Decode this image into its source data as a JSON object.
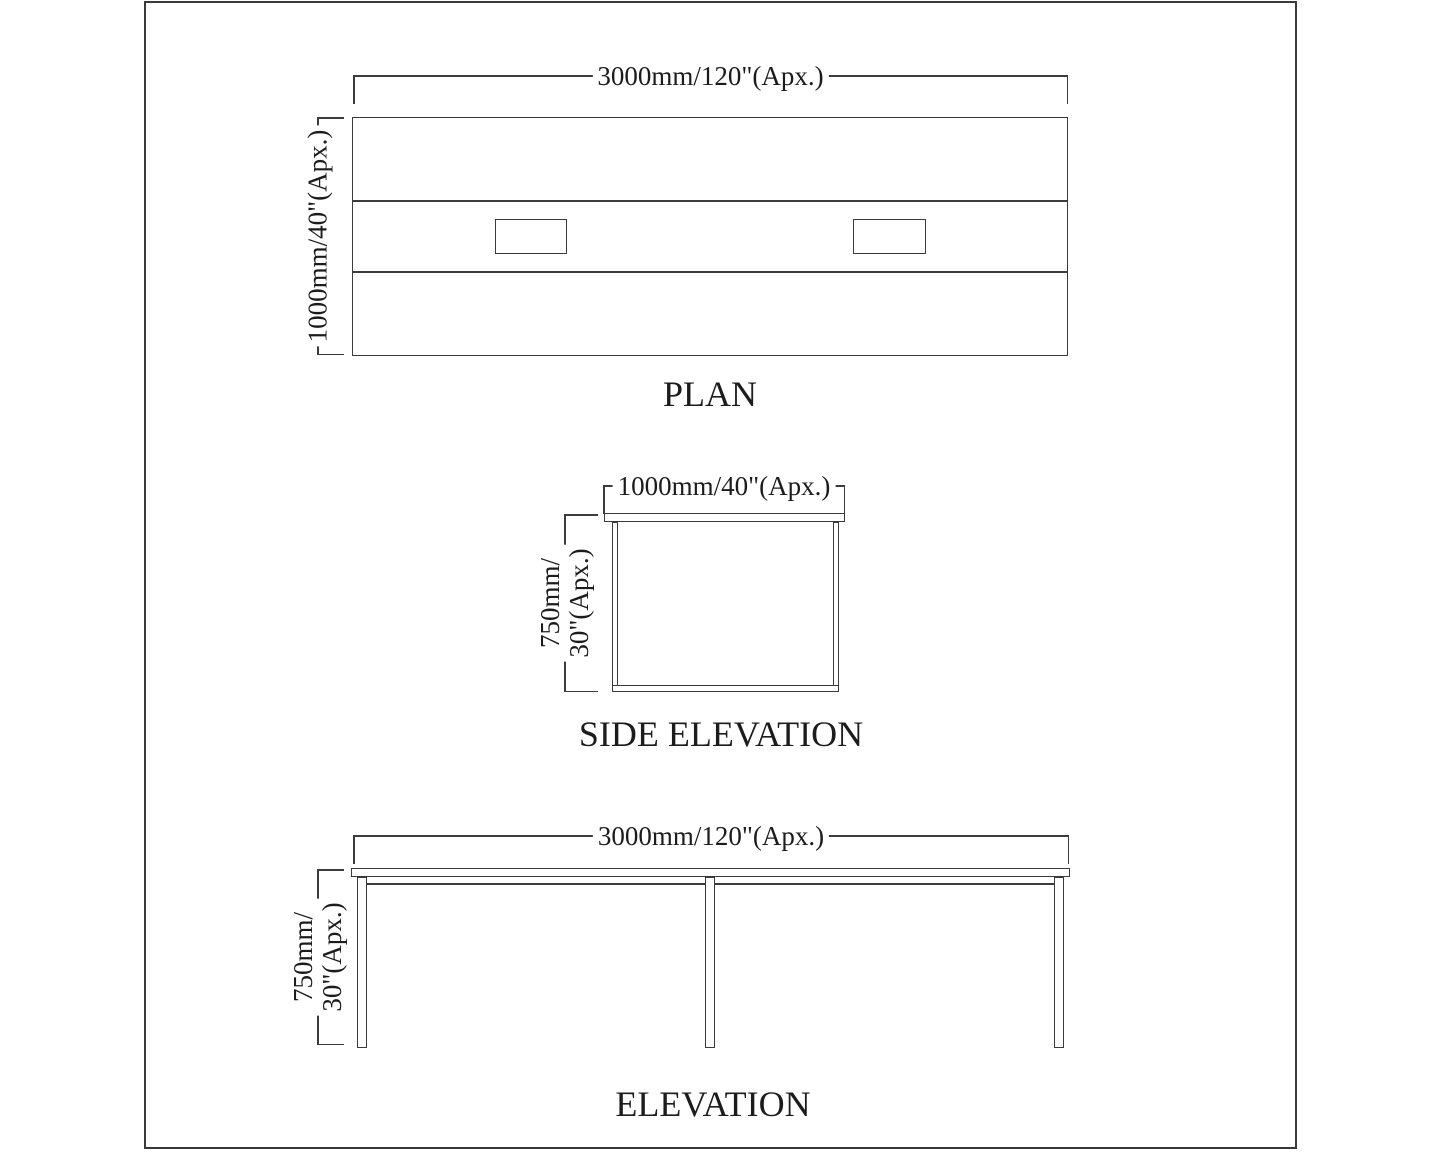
{
  "colors": {
    "line_color": "#3b3b3b",
    "text_color": "#1c1c1c",
    "border_color": "#3a3a3a",
    "sheet_bg": "#ffffff"
  },
  "views": {
    "plan": {
      "title": "PLAN",
      "width_dim": "3000mm/120\"(Apx.)",
      "depth_dim": "1000mm/40\"(Apx.)"
    },
    "side_elevation": {
      "title": "SIDE ELEVATION",
      "width_dim": "1000mm/40\"(Apx.)",
      "height_dim_line1": "750mm/",
      "height_dim_line2": "30\"(Apx.)"
    },
    "elevation": {
      "title": "ELEVATION",
      "width_dim": "3000mm/120\"(Apx.)",
      "height_dim_line1": "750mm/",
      "height_dim_line2": "30\"(Apx.)"
    }
  }
}
